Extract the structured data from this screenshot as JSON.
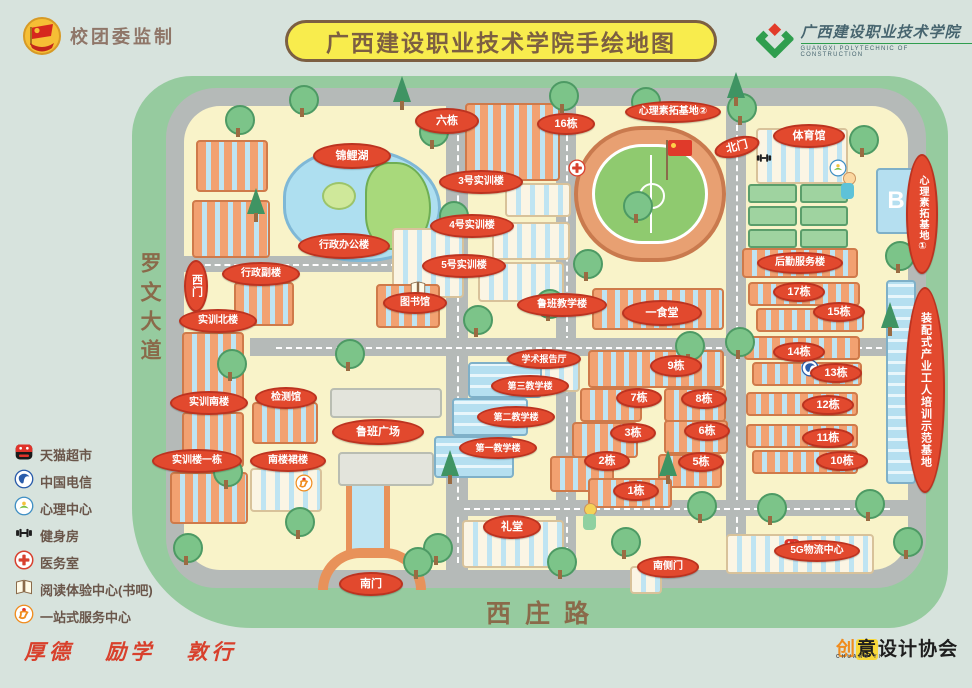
{
  "header": {
    "producer": "校团委监制",
    "title": "广西建设职业技术学院手绘地图",
    "school_name": "广西建设职业技术学院",
    "school_name_en": "GUANGXI  POLYTECHNIC  OF  CONSTRUCTION"
  },
  "roads": {
    "west": "罗文大道",
    "south": "西庄路"
  },
  "legend": [
    {
      "icon": "tmall-icon",
      "label": "天猫超市"
    },
    {
      "icon": "telecom-icon",
      "label": "中国电信"
    },
    {
      "icon": "psychology-icon",
      "label": "心理中心"
    },
    {
      "icon": "gym-icon",
      "label": "健身房"
    },
    {
      "icon": "clinic-icon",
      "label": "医务室"
    },
    {
      "icon": "reading-icon",
      "label": "阅读体验中心(书吧)"
    },
    {
      "icon": "onestop-icon",
      "label": "一站式服务中心"
    }
  ],
  "map_labels": [
    {
      "text": "六栋",
      "x": 447,
      "y": 121,
      "w": 64,
      "h": 26
    },
    {
      "text": "16栋",
      "x": 566,
      "y": 124,
      "w": 58,
      "h": 22
    },
    {
      "text": "心理素拓基地②",
      "x": 673,
      "y": 112,
      "w": 96,
      "h": 22,
      "fs": 10
    },
    {
      "text": "北门",
      "x": 737,
      "y": 147,
      "w": 46,
      "h": 20,
      "r": -14
    },
    {
      "text": "体育馆",
      "x": 809,
      "y": 136,
      "w": 72,
      "h": 24
    },
    {
      "text": "心理素拓基地①",
      "x": 922,
      "y": 214,
      "w": 32,
      "h": 120,
      "v": true,
      "fs": 10
    },
    {
      "text": "3号实训楼",
      "x": 481,
      "y": 182,
      "w": 84,
      "h": 24,
      "fs": 10
    },
    {
      "text": "4号实训楼",
      "x": 472,
      "y": 226,
      "w": 84,
      "h": 24,
      "fs": 10
    },
    {
      "text": "5号实训楼",
      "x": 464,
      "y": 266,
      "w": 84,
      "h": 24,
      "fs": 10
    },
    {
      "text": "锦鲤湖",
      "x": 352,
      "y": 156,
      "w": 78,
      "h": 26
    },
    {
      "text": "行政办公楼",
      "x": 344,
      "y": 246,
      "w": 92,
      "h": 26,
      "fs": 10
    },
    {
      "text": "行政副楼",
      "x": 261,
      "y": 274,
      "w": 78,
      "h": 24,
      "fs": 10
    },
    {
      "text": "西门",
      "x": 196,
      "y": 286,
      "w": 24,
      "h": 52,
      "v": true
    },
    {
      "text": "图书馆",
      "x": 415,
      "y": 303,
      "w": 64,
      "h": 22,
      "fs": 10
    },
    {
      "text": "实训北楼",
      "x": 218,
      "y": 321,
      "w": 78,
      "h": 24,
      "fs": 10
    },
    {
      "text": "检测馆",
      "x": 286,
      "y": 398,
      "w": 62,
      "h": 22,
      "fs": 10
    },
    {
      "text": "实训南楼",
      "x": 209,
      "y": 403,
      "w": 78,
      "h": 24,
      "fs": 10
    },
    {
      "text": "实训楼一栋",
      "x": 197,
      "y": 461,
      "w": 90,
      "h": 24,
      "fs": 10
    },
    {
      "text": "南楼裙楼",
      "x": 288,
      "y": 461,
      "w": 76,
      "h": 22,
      "fs": 10
    },
    {
      "text": "鲁班广场",
      "x": 378,
      "y": 432,
      "w": 92,
      "h": 26
    },
    {
      "text": "鲁班教学楼",
      "x": 562,
      "y": 305,
      "w": 90,
      "h": 24,
      "fs": 10
    },
    {
      "text": "学术报告厅",
      "x": 544,
      "y": 359,
      "w": 74,
      "h": 20,
      "fs": 9
    },
    {
      "text": "第三教学楼",
      "x": 530,
      "y": 386,
      "w": 78,
      "h": 22,
      "fs": 9
    },
    {
      "text": "第二教学楼",
      "x": 516,
      "y": 417,
      "w": 78,
      "h": 22,
      "fs": 9
    },
    {
      "text": "第一教学楼",
      "x": 498,
      "y": 448,
      "w": 78,
      "h": 22,
      "fs": 9
    },
    {
      "text": "礼堂",
      "x": 512,
      "y": 527,
      "w": 58,
      "h": 24
    },
    {
      "text": "一食堂",
      "x": 662,
      "y": 313,
      "w": 80,
      "h": 26
    },
    {
      "text": "9栋",
      "x": 676,
      "y": 366,
      "w": 52,
      "h": 22
    },
    {
      "text": "7栋",
      "x": 639,
      "y": 398,
      "w": 46,
      "h": 20
    },
    {
      "text": "8栋",
      "x": 704,
      "y": 399,
      "w": 46,
      "h": 20
    },
    {
      "text": "3栋",
      "x": 633,
      "y": 433,
      "w": 46,
      "h": 20
    },
    {
      "text": "6栋",
      "x": 707,
      "y": 431,
      "w": 46,
      "h": 20
    },
    {
      "text": "2栋",
      "x": 607,
      "y": 461,
      "w": 46,
      "h": 20
    },
    {
      "text": "5栋",
      "x": 701,
      "y": 462,
      "w": 46,
      "h": 20
    },
    {
      "text": "1栋",
      "x": 636,
      "y": 491,
      "w": 46,
      "h": 20
    },
    {
      "text": "南门",
      "x": 371,
      "y": 584,
      "w": 64,
      "h": 24
    },
    {
      "text": "南侧门",
      "x": 668,
      "y": 567,
      "w": 62,
      "h": 22,
      "fs": 10
    },
    {
      "text": "后勤服务楼",
      "x": 800,
      "y": 263,
      "w": 86,
      "h": 22,
      "fs": 10
    },
    {
      "text": "17栋",
      "x": 799,
      "y": 292,
      "w": 52,
      "h": 20
    },
    {
      "text": "15栋",
      "x": 839,
      "y": 312,
      "w": 52,
      "h": 20
    },
    {
      "text": "14栋",
      "x": 799,
      "y": 352,
      "w": 52,
      "h": 20
    },
    {
      "text": "13栋",
      "x": 836,
      "y": 373,
      "w": 52,
      "h": 20
    },
    {
      "text": "12栋",
      "x": 828,
      "y": 405,
      "w": 52,
      "h": 20
    },
    {
      "text": "11栋",
      "x": 828,
      "y": 438,
      "w": 52,
      "h": 20
    },
    {
      "text": "10栋",
      "x": 842,
      "y": 461,
      "w": 52,
      "h": 20
    },
    {
      "text": "装配式产业工人培训示范基地",
      "x": 925,
      "y": 390,
      "w": 40,
      "h": 206,
      "v": true,
      "fs": 11
    },
    {
      "text": "5G物流中心",
      "x": 817,
      "y": 551,
      "w": 86,
      "h": 22,
      "fs": 10
    }
  ],
  "map_icons": [
    {
      "icon": "clinic-icon",
      "x": 577,
      "y": 168
    },
    {
      "icon": "gym-icon",
      "x": 764,
      "y": 158
    },
    {
      "icon": "psychology-icon",
      "x": 838,
      "y": 168
    },
    {
      "icon": "telecom-icon",
      "x": 810,
      "y": 368
    },
    {
      "icon": "tmall-icon",
      "x": 792,
      "y": 546
    },
    {
      "icon": "reading-icon",
      "x": 418,
      "y": 288
    },
    {
      "icon": "onestop-icon",
      "x": 304,
      "y": 483
    }
  ],
  "map_marks": {
    "b_building": "B"
  },
  "footer": {
    "motto": "厚德 励学 敦行",
    "association": "创意设计协会",
    "association_en": "CHUANG    YI"
  },
  "colors": {
    "bubble_red": "#e2492e",
    "map_green": "#96cb9f",
    "campus_cream": "#f9f3c9",
    "road_gray": "#b5bab8",
    "banner_yellow": "#f8ec4d",
    "motto_red": "#d8402c"
  }
}
